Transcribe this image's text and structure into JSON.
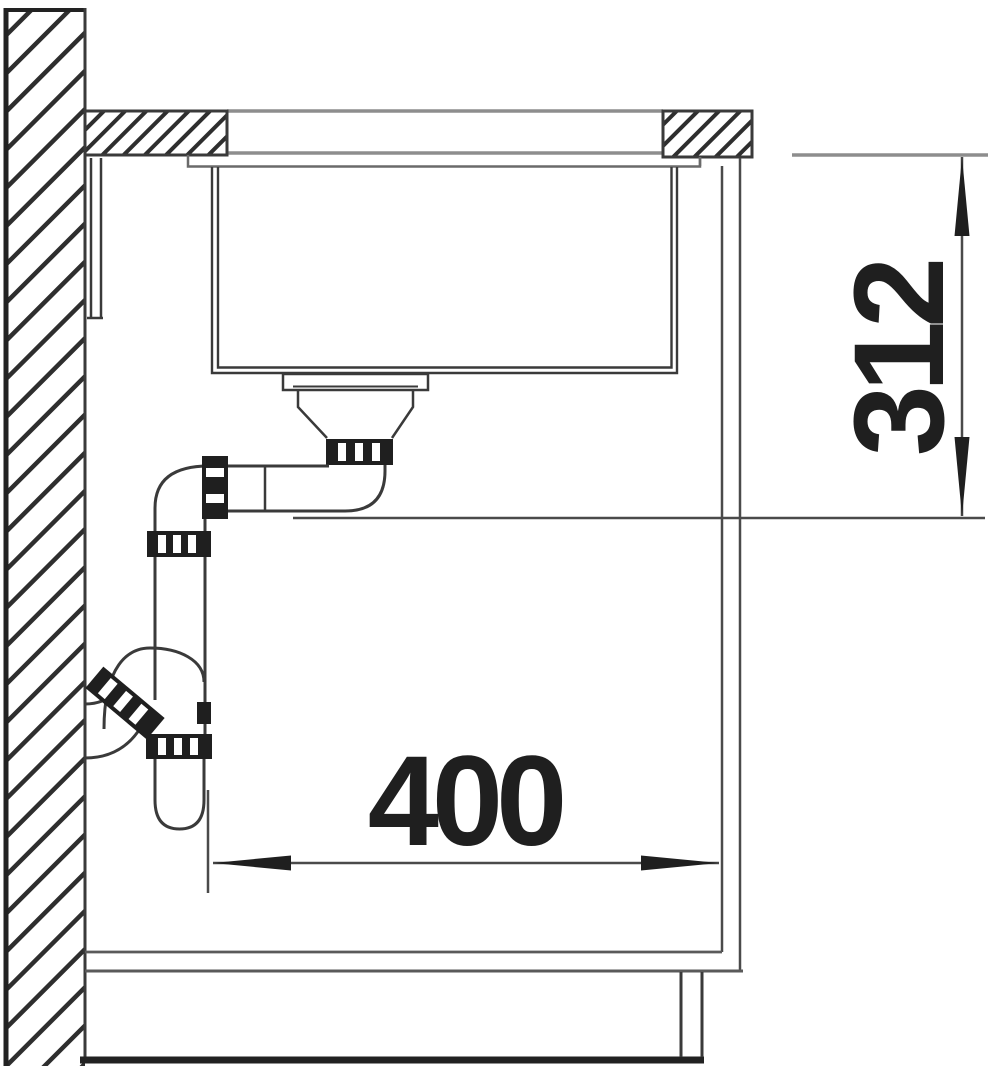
{
  "dimensions": {
    "horizontal": {
      "label": "400"
    },
    "vertical": {
      "label": "312"
    }
  },
  "colors": {
    "line_dark": "#3a3a3a",
    "line_gray": "#8d8d8d",
    "line_mid": "#5a5a5a",
    "ink": "#1f1f1f",
    "background": "#ffffff"
  }
}
